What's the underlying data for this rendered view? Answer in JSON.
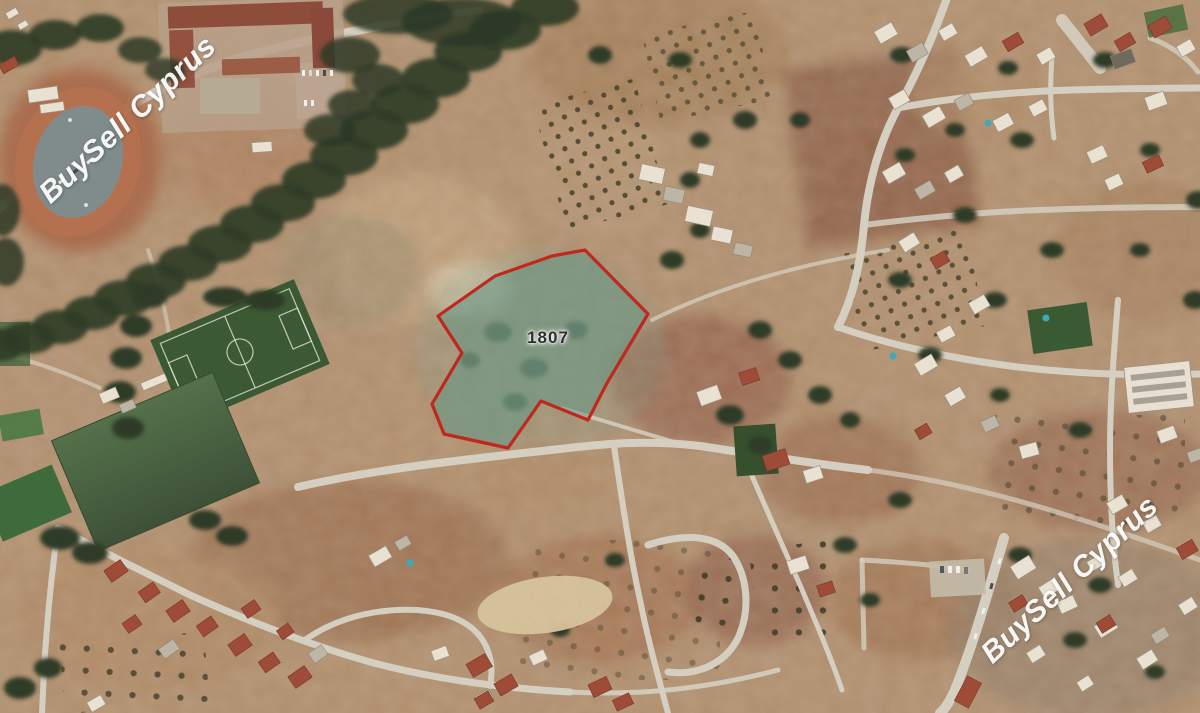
{
  "map": {
    "plot": {
      "label": "1807"
    },
    "watermarks": [
      {
        "text": "BuySell Cyprus"
      },
      {
        "text": "BuySell Cyprus"
      }
    ]
  },
  "theme": {
    "plot-stroke": "#c0281e",
    "plot-fill": "rgba(98,152,134,0.55)",
    "watermark-color": "#ffffff",
    "plot-label-color": "#2e2e2e"
  }
}
